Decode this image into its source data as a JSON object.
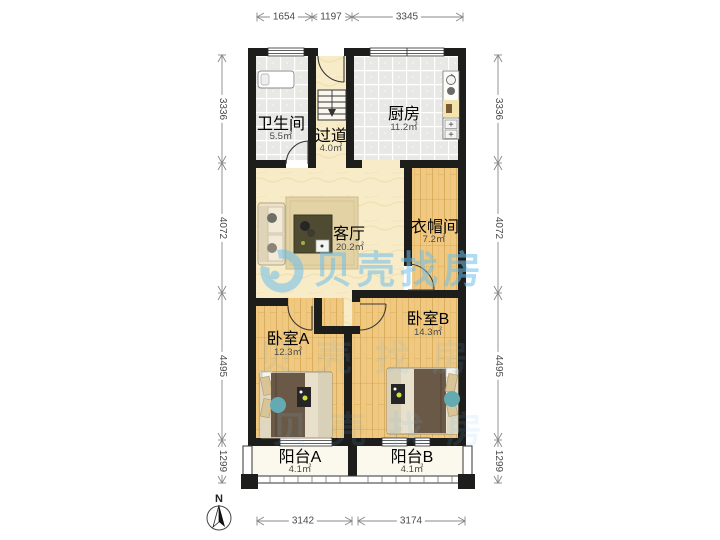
{
  "watermark": {
    "brand": "贝壳找房",
    "color": "#6ebfeb"
  },
  "compass": {
    "label": "N"
  },
  "rooms": {
    "bathroom": {
      "name": "卫生间",
      "area": "5.5㎡"
    },
    "hallway": {
      "name": "过道",
      "area": "4.0㎡"
    },
    "kitchen": {
      "name": "厨房",
      "area": "11.2㎡"
    },
    "living": {
      "name": "客厅",
      "area": "20.2㎡"
    },
    "cloakroom": {
      "name": "衣帽间",
      "area": "7.2㎡"
    },
    "bedroom_a": {
      "name": "卧室A",
      "area": "12.3㎡"
    },
    "bedroom_b": {
      "name": "卧室B",
      "area": "14.3㎡"
    },
    "balcony_a": {
      "name": "阳台A",
      "area": "4.1㎡"
    },
    "balcony_b": {
      "name": "阳台B",
      "area": "4.1㎡"
    }
  },
  "dimensions": {
    "top": [
      "1654",
      "1197",
      "3345"
    ],
    "bottom": [
      "3142",
      "3174"
    ],
    "left": [
      "3336",
      "4072",
      "4495",
      "1299"
    ],
    "right": [
      "3336",
      "4072",
      "4495",
      "1299"
    ]
  },
  "colors": {
    "wall": "#1d1d1b",
    "wood_floor": "#f1c87f",
    "tile_floor": "#e8e8e5",
    "warm_floor": "#f8ecc8",
    "balcony_floor": "#fbf8ed",
    "watermark_blue": "#6ebfeb",
    "accent_teal": "#64aab2"
  }
}
